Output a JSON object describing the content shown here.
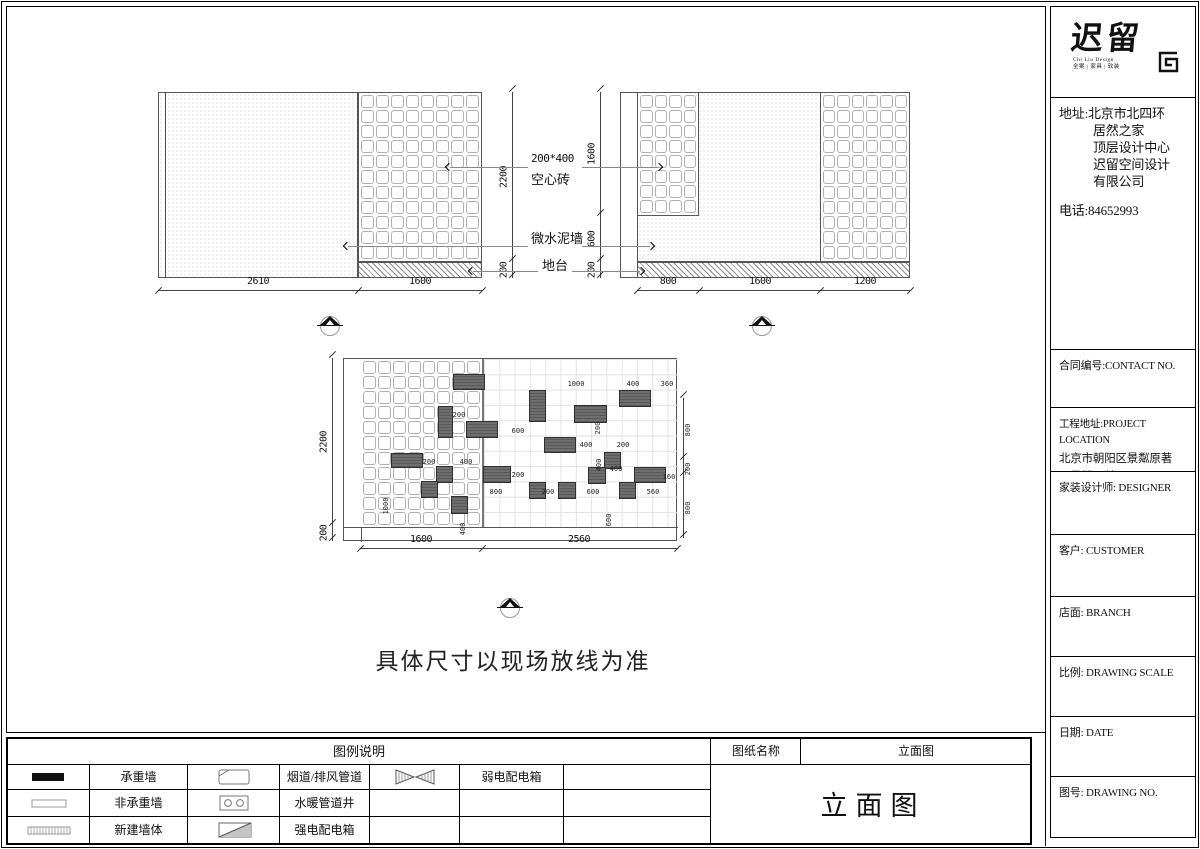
{
  "page": {
    "note": "具体尺寸以现场放线为准"
  },
  "logo": {
    "name_zh": "迟留",
    "sub_en": "Chi Liu Design",
    "sub_zh": "全案 | 家具 | 软装"
  },
  "sidebar": {
    "address_line1": "地址:北京市北四环",
    "address_rest": [
      "居然之家",
      "顶层设计中心",
      "迟留空间设计",
      "有限公司"
    ],
    "phone": "电话:84652993",
    "contract": "合同编号:CONTACT NO.",
    "project_label": "工程地址:PROJECT LOCATION",
    "project_lines": [
      "北京市朝阳区景粼原著",
      "20号楼三单元101"
    ],
    "designer": "家装设计师: DESIGNER",
    "customer": "客户: CUSTOMER",
    "branch": "店面: BRANCH",
    "scale": "比例: DRAWING SCALE",
    "date": "日期: DATE",
    "drawing_no": "图号: DRAWING NO."
  },
  "legend": {
    "title": "图例说明",
    "sheet_name_label": "图纸名称",
    "sheet_name_value": "立面图",
    "sheet_title": "立面图",
    "items": [
      {
        "symbol": "load-bearing-wall",
        "label": "承重墙"
      },
      {
        "symbol": "flue-duct",
        "label": "烟道/排风管道"
      },
      {
        "symbol": "weak-power-box",
        "label": "弱电配电箱"
      },
      {
        "symbol": "non-bearing-wall",
        "label": "非承重墙"
      },
      {
        "symbol": "plumbing-shaft",
        "label": "水暖管道井"
      },
      {
        "symbol": "",
        "label": ""
      },
      {
        "symbol": "new-wall",
        "label": "新建墙体"
      },
      {
        "symbol": "strong-power-box",
        "label": "强电配电箱"
      },
      {
        "symbol": "",
        "label": ""
      }
    ]
  },
  "annotations": {
    "brick_line1": "200*400",
    "brick_line2": "空心砖",
    "wall": "微水泥墙",
    "platform": "地台"
  },
  "elevation_top_left": {
    "dims_bottom": [
      "2610",
      "1600"
    ],
    "dims_right": [
      "2200",
      "200"
    ]
  },
  "elevation_top_right": {
    "dims_bottom": [
      "800",
      "1600",
      "1200"
    ],
    "dims_left": [
      "1600",
      "600",
      "200"
    ]
  },
  "elevation_lower": {
    "dims_left": [
      "2200",
      "200"
    ],
    "dims_bottom": [
      "1600",
      "2560"
    ],
    "dims_right": [
      "800",
      "200",
      "800"
    ],
    "blocks": [
      [
        109,
        15,
        30,
        14
      ],
      [
        94,
        47,
        13,
        30
      ],
      [
        122,
        62,
        30,
        15
      ],
      [
        47,
        94,
        30,
        13
      ],
      [
        92,
        107,
        15,
        15
      ],
      [
        139,
        107,
        26,
        15
      ],
      [
        77,
        122,
        15,
        15
      ],
      [
        107,
        137,
        15,
        16
      ],
      [
        185,
        31,
        15,
        30
      ],
      [
        230,
        46,
        31,
        16
      ],
      [
        275,
        31,
        30,
        15
      ],
      [
        200,
        78,
        30,
        14
      ],
      [
        260,
        93,
        15,
        15
      ],
      [
        244,
        108,
        16,
        15
      ],
      [
        290,
        108,
        30,
        14
      ],
      [
        185,
        123,
        15,
        15
      ],
      [
        214,
        123,
        16,
        15
      ],
      [
        275,
        123,
        15,
        15
      ]
    ],
    "labels": [
      [
        232,
        25,
        "1000",
        0
      ],
      [
        289,
        25,
        "400",
        0
      ],
      [
        323,
        25,
        "360",
        0
      ],
      [
        115,
        56,
        "200",
        0
      ],
      [
        254,
        69,
        "200",
        1
      ],
      [
        174,
        72,
        "600",
        0
      ],
      [
        242,
        86,
        "400",
        0
      ],
      [
        279,
        86,
        "200",
        0
      ],
      [
        85,
        103,
        "200",
        0
      ],
      [
        122,
        103,
        "400",
        0
      ],
      [
        255,
        106,
        "400",
        1
      ],
      [
        272,
        110,
        "400",
        0
      ],
      [
        325,
        118,
        "160",
        0
      ],
      [
        174,
        116,
        "200",
        0
      ],
      [
        152,
        133,
        "800",
        0
      ],
      [
        204,
        133,
        "200",
        0
      ],
      [
        249,
        133,
        "600",
        0
      ],
      [
        309,
        133,
        "560",
        0
      ],
      [
        265,
        161,
        "600",
        1
      ],
      [
        42,
        147,
        "1000",
        1
      ],
      [
        119,
        170,
        "400",
        1
      ],
      [
        344,
        71,
        "800",
        1
      ],
      [
        344,
        110,
        "200",
        1
      ],
      [
        344,
        149,
        "800",
        1
      ]
    ]
  }
}
